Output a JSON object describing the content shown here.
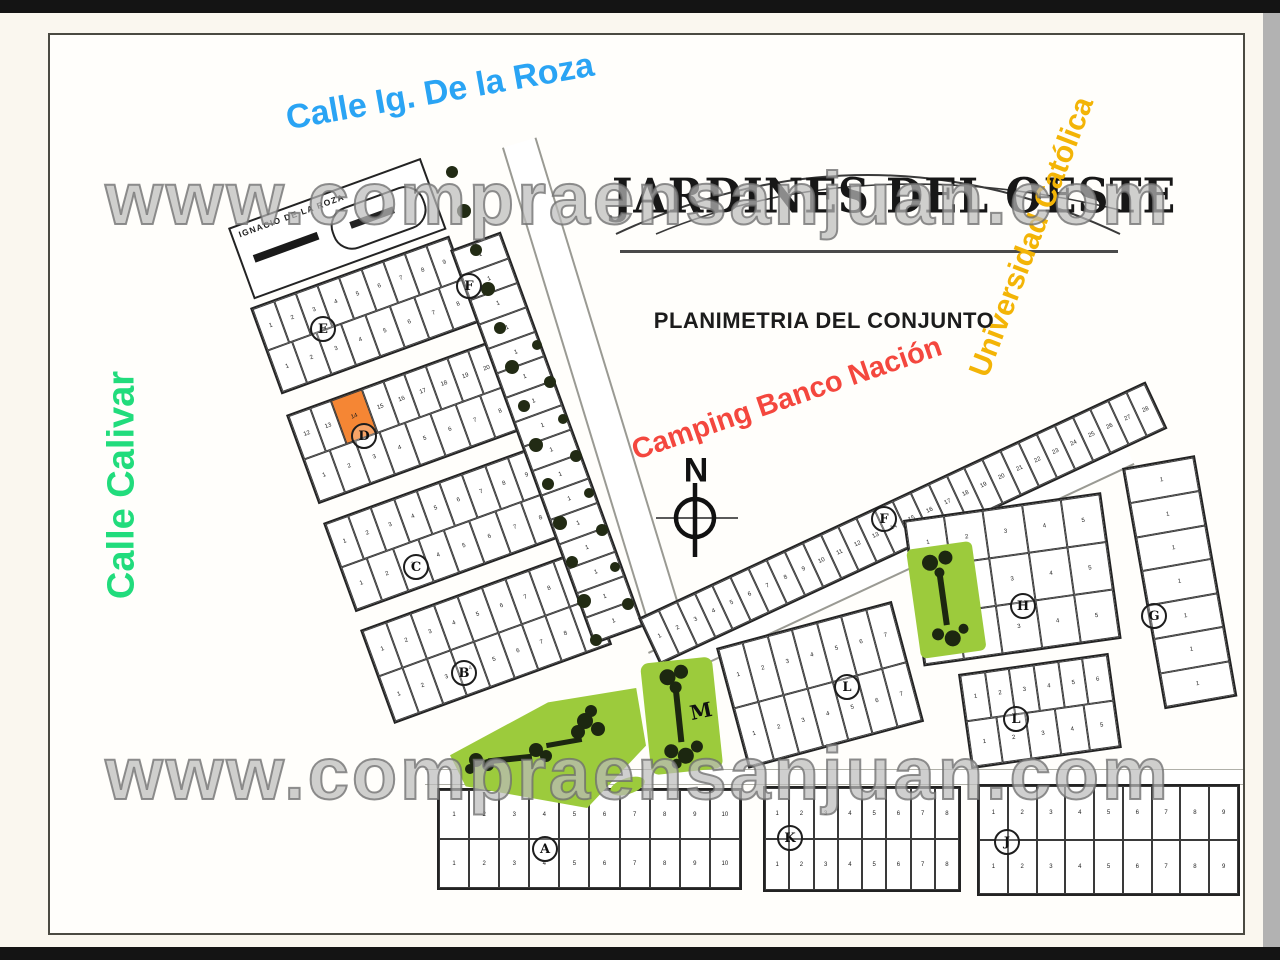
{
  "frame": {
    "top_bar_color": "#141414",
    "bottom_bar_color": "#141414",
    "outer_background": "#FAF7EF",
    "scrollbar_color": "#B2B2B2",
    "page_background": "#FFFEFB",
    "page_border_color": "#4A4A42"
  },
  "watermark": {
    "text": "www.compraensanjuan.com",
    "occurrences": 2
  },
  "header": {
    "title": "JARDINES DEL OESTE",
    "subtitle": "PLANIMETRIA DEL CONJUNTO"
  },
  "labels": {
    "calle_de_la_roza": {
      "text": "Calle Ig. De la Roza",
      "color": "#2AA4F4"
    },
    "calle_calivar": {
      "text": "Calle Calivar",
      "color": "#21DC7C"
    },
    "universidad": {
      "text": "Universidad Católica",
      "color": "#F3B406"
    },
    "camping": {
      "text": "Camping Banco Nación",
      "color": "#F4473E"
    },
    "street_on_map": {
      "text": "IGNACIO DE LA ROZA",
      "color": "#1A1A1A"
    }
  },
  "compass": {
    "label": "N"
  },
  "highlight_lot": {
    "block": "D",
    "row": 0,
    "index": 2,
    "number": "14",
    "color": "#F58634"
  },
  "park_color": "#9CCB3C",
  "blocks": [
    {
      "id": "E",
      "rows": [
        9,
        8
      ]
    },
    {
      "id": "D",
      "rows": [
        9,
        8
      ],
      "row_start": [
        12,
        1
      ]
    },
    {
      "id": "C",
      "rows": [
        9,
        8
      ]
    },
    {
      "id": "B",
      "rows": [
        9,
        9
      ]
    },
    {
      "id": "A",
      "rows": [
        10,
        10
      ]
    },
    {
      "id": "K",
      "rows": [
        8,
        8
      ]
    },
    {
      "id": "J",
      "rows": [
        9,
        9
      ]
    },
    {
      "id": "F_WEST",
      "stack": 16
    },
    {
      "id": "F_EAST",
      "strip_row": 28
    },
    {
      "id": "G",
      "stack": 7
    },
    {
      "id": "H",
      "rows": [
        5,
        5,
        5
      ]
    },
    {
      "id": "L1",
      "rows": [
        7,
        7
      ]
    },
    {
      "id": "L2",
      "rows": [
        6,
        5
      ]
    }
  ],
  "block_letters": [
    {
      "id": "E",
      "letter": "E",
      "circled": true
    },
    {
      "id": "D",
      "letter": "D",
      "circled": true
    },
    {
      "id": "C",
      "letter": "C",
      "circled": true
    },
    {
      "id": "B",
      "letter": "B",
      "circled": true
    },
    {
      "id": "A",
      "letter": "A",
      "circled": true
    },
    {
      "id": "K",
      "letter": "K",
      "circled": true
    },
    {
      "id": "J",
      "letter": "J",
      "circled": true
    },
    {
      "id": "F1",
      "letter": "F",
      "circled": true
    },
    {
      "id": "F2",
      "letter": "F",
      "circled": true
    },
    {
      "id": "G",
      "letter": "G",
      "circled": true
    },
    {
      "id": "H",
      "letter": "H",
      "circled": true
    },
    {
      "id": "L1",
      "letter": "L",
      "circled": true
    },
    {
      "id": "L2",
      "letter": "L",
      "circled": true
    },
    {
      "id": "M",
      "letter": "M",
      "circled": false
    }
  ]
}
